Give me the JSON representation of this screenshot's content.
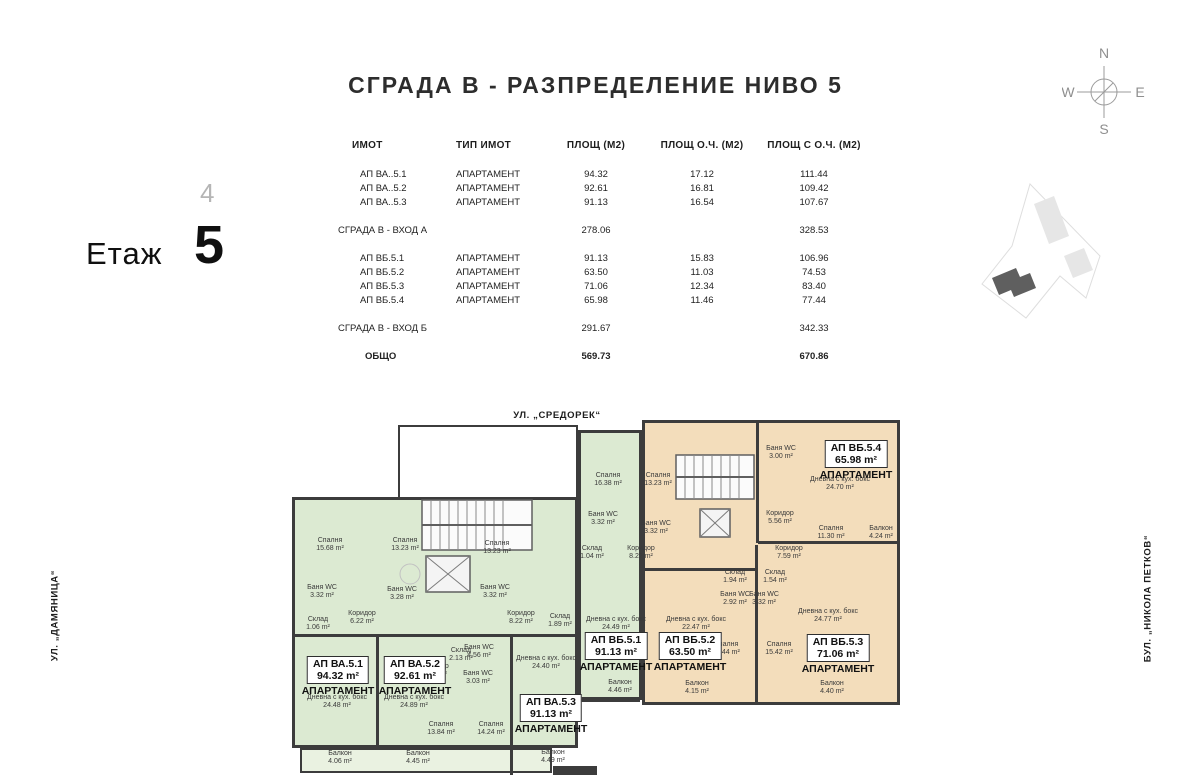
{
  "title": "СГРАДА В - РАЗПРЕДЕЛЕНИЕ НИВО 5",
  "floor": {
    "prev": "4",
    "label": "Етаж",
    "current": "5"
  },
  "compass": {
    "n": "N",
    "e": "E",
    "s": "S",
    "w": "W"
  },
  "streets": {
    "top": "УЛ. „СРЕДОРЕК“",
    "left": "УЛ. „ДАМЯНИЦА“",
    "right": "БУЛ. „НИКОЛА ПЕТКОВ“"
  },
  "table": {
    "headers": [
      "ИМОТ",
      "ТИП ИМОТ",
      "ПЛОЩ (М2)",
      "ПЛОЩ О.Ч. (М2)",
      "ПЛОЩ С О.Ч. (М2)"
    ],
    "rows": [
      {
        "name": "АП ВА..5.1",
        "type": "АПАРТАМЕНТ",
        "area": "94.32",
        "oc": "17.12",
        "total": "111.44",
        "kind": "apt",
        "gap": false
      },
      {
        "name": "АП ВА..5.2",
        "type": "АПАРТАМЕНТ",
        "area": "92.61",
        "oc": "16.81",
        "total": "109.42",
        "kind": "apt",
        "gap": false
      },
      {
        "name": "АП ВА..5.3",
        "type": "АПАРТАМЕНТ",
        "area": "91.13",
        "oc": "16.54",
        "total": "107.67",
        "kind": "apt",
        "gap": false
      },
      {
        "name": "СГРАДА В - ВХОД А",
        "type": "",
        "area": "278.06",
        "oc": "",
        "total": "328.53",
        "kind": "sub",
        "gap": true
      },
      {
        "name": "АП ВБ.5.1",
        "type": "АПАРТАМЕНТ",
        "area": "91.13",
        "oc": "15.83",
        "total": "106.96",
        "kind": "apt",
        "gap": true
      },
      {
        "name": "АП ВБ.5.2",
        "type": "АПАРТАМЕНТ",
        "area": "63.50",
        "oc": "11.03",
        "total": "74.53",
        "kind": "apt",
        "gap": false
      },
      {
        "name": "АП ВБ.5.3",
        "type": "АПАРТАМЕНТ",
        "area": "71.06",
        "oc": "12.34",
        "total": "83.40",
        "kind": "apt",
        "gap": false
      },
      {
        "name": "АП ВБ.5.4",
        "type": "АПАРТАМЕНТ",
        "area": "65.98",
        "oc": "11.46",
        "total": "77.44",
        "kind": "apt",
        "gap": false
      },
      {
        "name": "СГРАДА В - ВХОД Б",
        "type": "",
        "area": "291.67",
        "oc": "",
        "total": "342.33",
        "kind": "sub",
        "gap": true
      },
      {
        "name": "ОБЩО",
        "type": "",
        "area": "569.73",
        "oc": "",
        "total": "670.86",
        "kind": "tot",
        "gap": true
      }
    ]
  },
  "colors": {
    "green": "#dcead2",
    "green_light": "#eaf2e1",
    "orange": "#f3ddbb",
    "orange_light": "#f8ecd9",
    "white": "#ffffff",
    "wall": "#3c3c3c"
  },
  "plan": {
    "apartment_word": "АПАРТАМЕНТ",
    "blocks": [
      {
        "x": 292,
        "y": 497,
        "w": 286,
        "h": 251,
        "f": "green",
        "b": 3
      },
      {
        "x": 300,
        "y": 748,
        "w": 252,
        "h": 25,
        "f": "green_light",
        "b": 2
      },
      {
        "x": 578,
        "y": 430,
        "w": 64,
        "h": 270,
        "f": "green",
        "b": 3
      },
      {
        "x": 642,
        "y": 420,
        "w": 258,
        "h": 285,
        "f": "orange",
        "b": 3
      },
      {
        "x": 762,
        "y": 424,
        "w": 136,
        "h": 118,
        "f": "orange_light",
        "b": 0
      },
      {
        "x": 697,
        "y": 612,
        "w": 58,
        "h": 80,
        "f": "orange_light",
        "b": 0
      },
      {
        "x": 580,
        "y": 674,
        "w": 60,
        "h": 28,
        "f": "green_light",
        "b": 2
      },
      {
        "x": 644,
        "y": 674,
        "w": 106,
        "h": 28,
        "f": "orange_light",
        "b": 2
      },
      {
        "x": 866,
        "y": 505,
        "w": 34,
        "h": 55,
        "f": "orange_light",
        "b": 2
      },
      {
        "x": 398,
        "y": 425,
        "w": 180,
        "h": 74,
        "f": "white",
        "b": 2
      },
      {
        "x": 398,
        "y": 490,
        "w": 146,
        "h": 106,
        "f": "white",
        "b": 3
      },
      {
        "x": 656,
        "y": 425,
        "w": 116,
        "h": 120,
        "f": "white",
        "b": 3
      }
    ],
    "walls": [
      {
        "x": 376,
        "y": 636,
        "w": 3,
        "h": 112
      },
      {
        "x": 292,
        "y": 634,
        "w": 286,
        "h": 3
      },
      {
        "x": 510,
        "y": 636,
        "w": 3,
        "h": 139
      },
      {
        "x": 756,
        "y": 423,
        "w": 3,
        "h": 120
      },
      {
        "x": 758,
        "y": 541,
        "w": 142,
        "h": 3
      },
      {
        "x": 755,
        "y": 545,
        "w": 3,
        "h": 158
      },
      {
        "x": 642,
        "y": 568,
        "w": 114,
        "h": 3
      }
    ],
    "rooms": [
      {
        "n": "Спалня",
        "a": "15.68 m²",
        "x": 330,
        "y": 545
      },
      {
        "n": "Спалня",
        "a": "13.23 m²",
        "x": 405,
        "y": 545
      },
      {
        "n": "Баня WC",
        "a": "3.32 m²",
        "x": 322,
        "y": 592
      },
      {
        "n": "Баня WC",
        "a": "3.28 m²",
        "x": 402,
        "y": 594
      },
      {
        "n": "Склад",
        "a": "1.06 m²",
        "x": 318,
        "y": 624
      },
      {
        "n": "Коридор",
        "a": "6.22 m²",
        "x": 362,
        "y": 618
      },
      {
        "n": "Спалня",
        "a": "13.23 m²",
        "x": 497,
        "y": 548
      },
      {
        "n": "Баня WC",
        "a": "3.32 m²",
        "x": 495,
        "y": 592
      },
      {
        "n": "Дневна с кух. бокс",
        "a": "24.48 m²",
        "x": 337,
        "y": 702
      },
      {
        "n": "Балкон",
        "a": "4.06 m²",
        "x": 340,
        "y": 758
      },
      {
        "n": "Дневна с кух. бокс",
        "a": "24.89 m²",
        "x": 414,
        "y": 702
      },
      {
        "n": "Балкон",
        "a": "4.45 m²",
        "x": 418,
        "y": 758
      },
      {
        "n": "Коридор",
        "a": "9.49 m²",
        "x": 435,
        "y": 671
      },
      {
        "n": "Склад",
        "a": "2.13 m²",
        "x": 461,
        "y": 655
      },
      {
        "n": "Баня WC",
        "a": "4.56 m²",
        "x": 479,
        "y": 652
      },
      {
        "n": "Баня WC",
        "a": "3.03 m²",
        "x": 478,
        "y": 678
      },
      {
        "n": "Спалня",
        "a": "13.84 m²",
        "x": 441,
        "y": 729
      },
      {
        "n": "Спалня",
        "a": "14.24 m²",
        "x": 491,
        "y": 729
      },
      {
        "n": "Коридор",
        "a": "8.22 m²",
        "x": 521,
        "y": 618
      },
      {
        "n": "Склад",
        "a": "1.89 m²",
        "x": 560,
        "y": 621
      },
      {
        "n": "Дневна с кух. бокс",
        "a": "24.40 m²",
        "x": 546,
        "y": 663
      },
      {
        "n": "Балкон",
        "a": "4.49 m²",
        "x": 553,
        "y": 757
      },
      {
        "n": "Спалня",
        "a": "16.38 m²",
        "x": 608,
        "y": 480
      },
      {
        "n": "Спалня",
        "a": "13.23 m²",
        "x": 658,
        "y": 480
      },
      {
        "n": "Баня WC",
        "a": "3.32 m²",
        "x": 603,
        "y": 519
      },
      {
        "n": "Баня WC",
        "a": "3.32 m²",
        "x": 656,
        "y": 528
      },
      {
        "n": "Склад",
        "a": "1.04 m²",
        "x": 592,
        "y": 553
      },
      {
        "n": "Коридор",
        "a": "8.22 m²",
        "x": 641,
        "y": 553
      },
      {
        "n": "Дневна с кух. бокс",
        "a": "24.49 m²",
        "x": 616,
        "y": 624
      },
      {
        "n": "Балкон",
        "a": "4.46 m²",
        "x": 620,
        "y": 687
      },
      {
        "n": "Баня WC",
        "a": "3.00 m²",
        "x": 781,
        "y": 453
      },
      {
        "n": "Дневна с кух. бокс",
        "a": "24.70 m²",
        "x": 840,
        "y": 484
      },
      {
        "n": "Коридор",
        "a": "5.56 m²",
        "x": 780,
        "y": 518
      },
      {
        "n": "Спалня",
        "a": "11.30 m²",
        "x": 831,
        "y": 533
      },
      {
        "n": "Балкон",
        "a": "4.24 m²",
        "x": 881,
        "y": 533
      },
      {
        "n": "Коридор",
        "a": "7.59 m²",
        "x": 789,
        "y": 553
      },
      {
        "n": "Склад",
        "a": "1.94 m²",
        "x": 735,
        "y": 577
      },
      {
        "n": "Баня WC",
        "a": "2.92 m²",
        "x": 735,
        "y": 599
      },
      {
        "n": "Склад",
        "a": "1.54 m²",
        "x": 775,
        "y": 577
      },
      {
        "n": "Баня WC",
        "a": "3.32 m²",
        "x": 764,
        "y": 599
      },
      {
        "n": "Дневна с кух. бокс",
        "a": "22.47 m²",
        "x": 696,
        "y": 624
      },
      {
        "n": "Балкон",
        "a": "4.15 m²",
        "x": 697,
        "y": 688
      },
      {
        "n": "Спалня",
        "a": "15.44 m²",
        "x": 726,
        "y": 649
      },
      {
        "n": "Спалня",
        "a": "15.42 m²",
        "x": 779,
        "y": 649
      },
      {
        "n": "Дневна с кух. бокс",
        "a": "24.77 m²",
        "x": 828,
        "y": 616
      },
      {
        "n": "Балкон",
        "a": "4.40 m²",
        "x": 832,
        "y": 688
      }
    ],
    "apartments": [
      {
        "name": "АП ВА.5.1",
        "area": "94.32 m²",
        "x": 338,
        "y": 656
      },
      {
        "name": "АП ВА.5.2",
        "area": "92.61 m²",
        "x": 415,
        "y": 656
      },
      {
        "name": "АП ВА.5.3",
        "area": "91.13 m²",
        "x": 551,
        "y": 694
      },
      {
        "name": "АП ВБ.5.1",
        "area": "91.13 m²",
        "x": 616,
        "y": 632
      },
      {
        "name": "АП ВБ.5.2",
        "area": "63.50 m²",
        "x": 690,
        "y": 632
      },
      {
        "name": "АП ВБ.5.3",
        "area": "71.06 m²",
        "x": 838,
        "y": 634
      },
      {
        "name": "АП ВБ.5.4",
        "area": "65.98 m²",
        "x": 856,
        "y": 440
      }
    ]
  }
}
